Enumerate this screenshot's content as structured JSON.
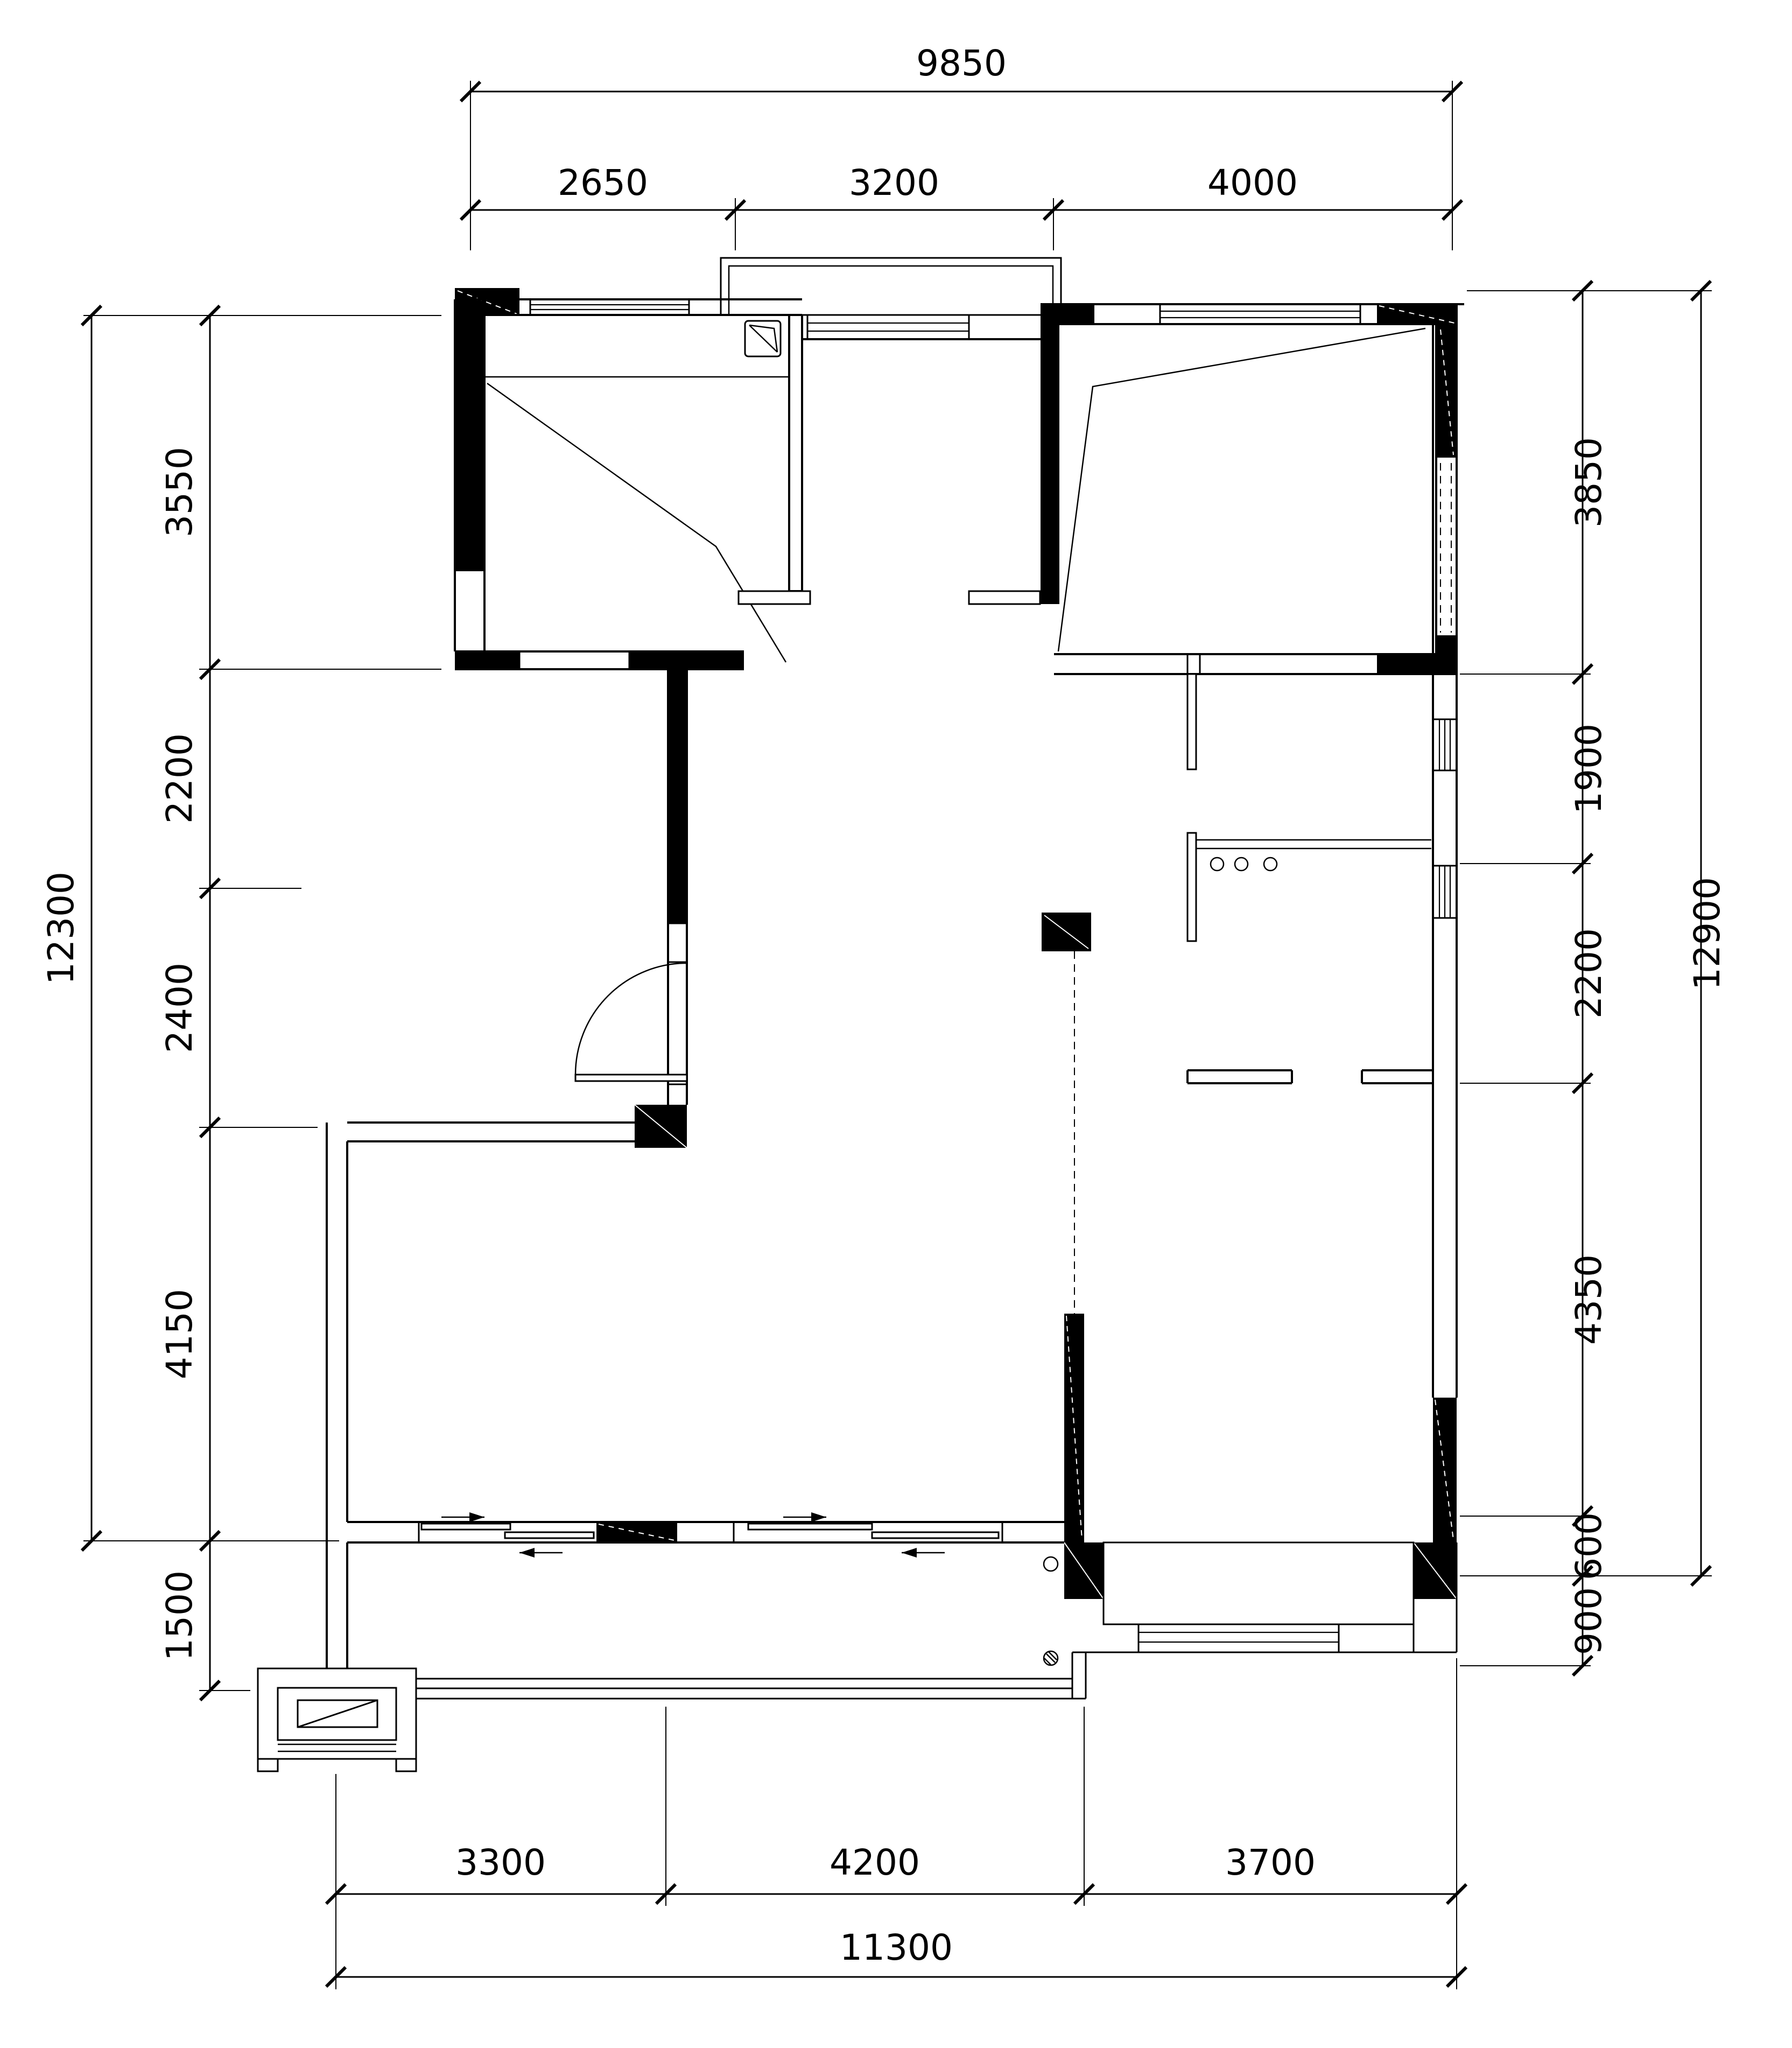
{
  "drawing": {
    "type": "residential floor plan",
    "colors": {
      "ink": "#000000",
      "paper": "#ffffff",
      "wall_fill": "#000000"
    }
  },
  "dimensions": {
    "top": {
      "overall": "9850",
      "segments": [
        "2650",
        "3200",
        "4000"
      ]
    },
    "bottom": {
      "overall": "11300",
      "segments": [
        "3300",
        "4200",
        "3700"
      ]
    },
    "left": {
      "overall": "12300",
      "segments": [
        "3550",
        "2200",
        "2400",
        "4150",
        "1500"
      ]
    },
    "right": {
      "overall": "12900",
      "segments": [
        "3850",
        "1900",
        "2200",
        "4350",
        "600",
        "900"
      ]
    }
  },
  "symbols": {
    "door_arc": "swing door",
    "sliding_door": "double sliding panels with direction arrows",
    "burners": "3 cooktop circles",
    "drains": "2 floor drain circles",
    "shaft": "exterior shaft box with diagonal"
  }
}
